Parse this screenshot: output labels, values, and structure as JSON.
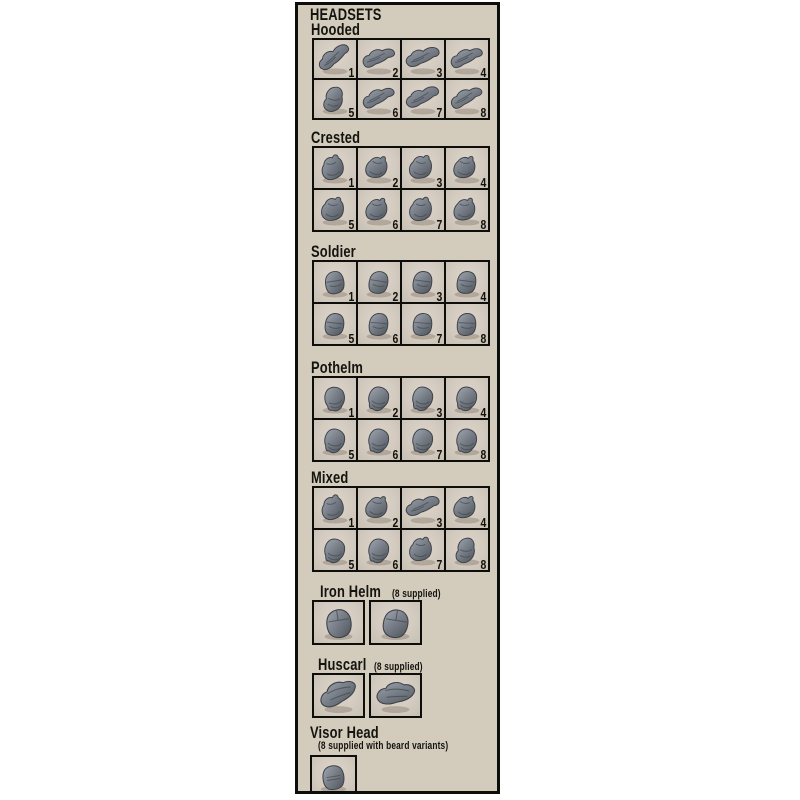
{
  "title": "HEADSETS",
  "sections": [
    {
      "name": "Hooded",
      "note": "",
      "note_below": false,
      "columns": 4,
      "large": false,
      "sculpt": "hood",
      "cells": [
        "1",
        "2",
        "3",
        "4",
        "5",
        "6",
        "7",
        "8"
      ]
    },
    {
      "name": "Crested",
      "note": "",
      "note_below": false,
      "columns": 4,
      "large": false,
      "sculpt": "crest",
      "cells": [
        "1",
        "2",
        "3",
        "4",
        "5",
        "6",
        "7",
        "8"
      ]
    },
    {
      "name": "Soldier",
      "note": "",
      "note_below": false,
      "columns": 4,
      "large": false,
      "sculpt": "soldier",
      "cells": [
        "1",
        "2",
        "3",
        "4",
        "5",
        "6",
        "7",
        "8"
      ]
    },
    {
      "name": "Pothelm",
      "note": "",
      "note_below": false,
      "columns": 4,
      "large": false,
      "sculpt": "pothelm",
      "cells": [
        "1",
        "2",
        "3",
        "4",
        "5",
        "6",
        "7",
        "8"
      ]
    },
    {
      "name": "Mixed",
      "note": "",
      "note_below": false,
      "columns": 4,
      "large": false,
      "sculpt": "mixed",
      "cells": [
        "1",
        "2",
        "3",
        "4",
        "5",
        "6",
        "7",
        "8"
      ]
    },
    {
      "name": "Iron Helm",
      "note": "(8 supplied)",
      "note_below": false,
      "columns": 2,
      "large": true,
      "sculpt": "iron",
      "cells": [
        "",
        ""
      ]
    },
    {
      "name": "Huscarl",
      "note": "(8 supplied)",
      "note_below": false,
      "columns": 2,
      "large": true,
      "sculpt": "huscarl",
      "cells": [
        "",
        ""
      ]
    },
    {
      "name": "Visor Head",
      "note": "(8 supplied with beard variants)",
      "note_below": true,
      "columns": 1,
      "large": true,
      "sculpt": "visor",
      "cells": [
        ""
      ]
    }
  ],
  "colors": {
    "page_bg": "#ffffff",
    "panel_bg": "#d3ccbc",
    "panel_border": "#0d0d0b",
    "photo_bg": "#d4cbc0",
    "sculpt_grey": "#7f858d",
    "text": "#141310"
  }
}
